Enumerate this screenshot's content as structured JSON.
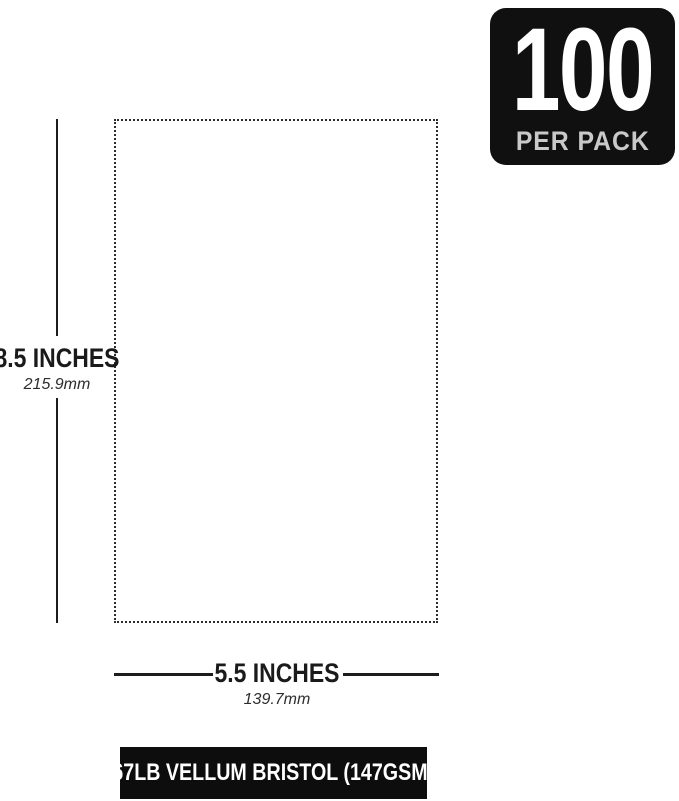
{
  "badge": {
    "count": "100",
    "label": "PER PACK"
  },
  "dimensions": {
    "height": {
      "inches": "8.5 INCHES",
      "mm": "215.9mm"
    },
    "width": {
      "inches": "5.5 INCHES",
      "mm": "139.7mm"
    }
  },
  "footer": {
    "label": "67LB VELLUM BRISTOL (147GSM)"
  },
  "colors": {
    "background": "#ffffff",
    "badge_bg": "#101010",
    "badge_count": "#ffffff",
    "badge_label": "#c9c9c9",
    "dimension_line": "#1c1c1c",
    "dotted_outline": "#2c2c2c",
    "footer_bg": "#0d0d0d",
    "footer_text": "#ffffff"
  }
}
